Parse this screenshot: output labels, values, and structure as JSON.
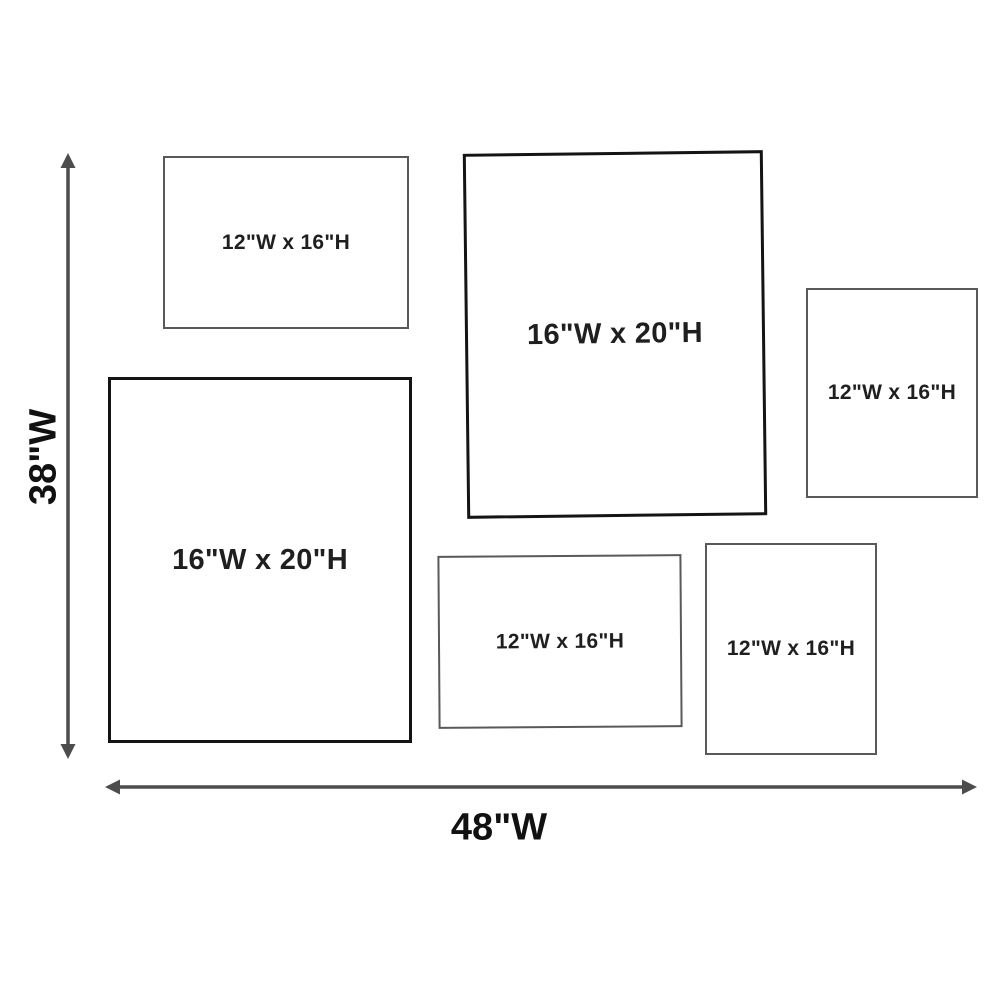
{
  "frames": [
    {
      "id": "top-left",
      "label": "12\"W x 16\"H",
      "size": "12x16",
      "orientation": "landscape"
    },
    {
      "id": "top-center",
      "label": "16\"W x 20\"H",
      "size": "16x20",
      "orientation": "portrait"
    },
    {
      "id": "right",
      "label": "12\"W x 16\"H",
      "size": "12x16",
      "orientation": "portrait"
    },
    {
      "id": "left-large",
      "label": "16\"W x 20\"H",
      "size": "16x20",
      "orientation": "portrait"
    },
    {
      "id": "bottom-center",
      "label": "12\"W x 16\"H",
      "size": "12x16",
      "orientation": "landscape"
    },
    {
      "id": "bottom-right",
      "label": "12\"W x 16\"H",
      "size": "12x16",
      "orientation": "portrait"
    }
  ],
  "dimension_labels": {
    "vertical": "38\"W",
    "horizontal": "48\"W"
  },
  "colors": {
    "background": "#ffffff",
    "frame_border_thin": "#595959",
    "frame_border_thick": "#141414",
    "arrow": "#4d4d4d",
    "text": "#1f1f1f"
  }
}
